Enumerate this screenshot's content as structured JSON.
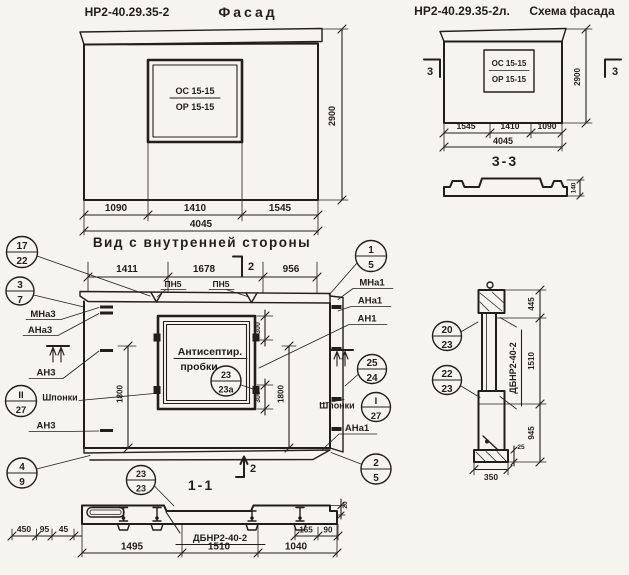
{
  "paper_color": "#f6f4ee",
  "ink_color": "#221f1b",
  "titles": {
    "facade_code": "НР2-40.29.35-2",
    "facade_word": "Фасад",
    "schema_code": "НР2-40.29.35-2л.",
    "schema_word": "Схема фасада",
    "inner_view": "Вид с внутренней стороны",
    "section_33": "3-3",
    "section_11": "1-1"
  },
  "facade": {
    "window_line1": "ОС 15-15",
    "window_line2": "ОР 15-15",
    "dim_left": "1090",
    "dim_mid": "1410",
    "dim_right": "1545",
    "dim_total": "4045",
    "dim_height": "2900"
  },
  "schema": {
    "window_line1": "ОС 15-15",
    "window_line2": "ОР 15-15",
    "dim_left": "1545",
    "dim_mid": "1410",
    "dim_right": "1090",
    "dim_total": "4045",
    "dim_height": "2900",
    "section_mark": "3",
    "profile_dim": "140"
  },
  "inner": {
    "dim_top_left": "1411",
    "dim_top_mid": "1678",
    "dim_top_right": "956",
    "dim_300_top": "300",
    "dim_300_bottom": "300",
    "dim_1800_left": "1800",
    "dim_1800_right": "1800",
    "section_mark_2": "2",
    "pn5_left": "ПН5",
    "pn5_right": "ПН5",
    "mna3": "МНа3",
    "ana3": "АНа3",
    "an3_top": "АН3",
    "an3_bottom": "АН3",
    "shponki_left": "Шпонки",
    "mna1": "МНа1",
    "ana1": "АНа1",
    "an1": "АН1",
    "ana1_b": "АНа1",
    "shponki_right": "Шпонки",
    "window_note_line1": "Антисептир.",
    "window_note_line2": "пробки"
  },
  "circles": {
    "c17_22": {
      "top": "17",
      "bot": "22"
    },
    "c3_7": {
      "top": "3",
      "bot": "7"
    },
    "c2r_27": {
      "top": "II",
      "bot": "27"
    },
    "c4_9": {
      "top": "4",
      "bot": "9"
    },
    "c1_5": {
      "top": "1",
      "bot": "5"
    },
    "c25_24": {
      "top": "25",
      "bot": "24"
    },
    "c1r_27": {
      "top": "I",
      "bot": "27"
    },
    "c2_5": {
      "top": "2",
      "bot": "5"
    },
    "c23_23a": {
      "top": "23",
      "bot": "23а"
    },
    "c23_23": {
      "top": "23",
      "bot": "23"
    },
    "c20_23": {
      "top": "20",
      "bot": "23"
    },
    "c22_23": {
      "top": "22",
      "bot": "23"
    }
  },
  "sec11": {
    "label": "ДБНР2-40-2",
    "d450": "450",
    "d95": "95",
    "d45": "45",
    "d165": "165",
    "d90": "90",
    "d20": "20",
    "d1495": "1495",
    "d1510": "1510",
    "d1040": "1040"
  },
  "sec22": {
    "label": "ДБНР2-40-2",
    "d445": "445",
    "d1510": "1510",
    "d945": "945",
    "d25": "25",
    "d350": "350"
  }
}
